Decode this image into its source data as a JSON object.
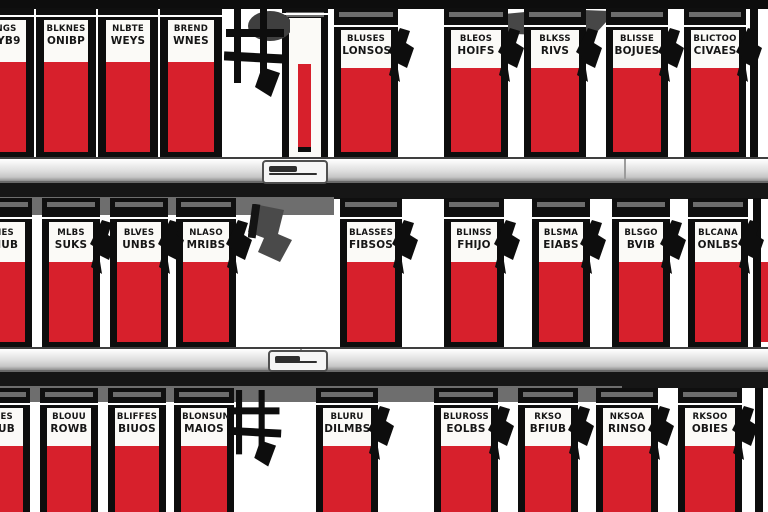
{
  "scene": {
    "description": "Illustration of store shelves stocked with red and white product packs bearing black pseudo-text labels and black hanging tags",
    "colors": {
      "pack_red": "#d7202c",
      "pack_black": "#0d0d0d",
      "label_text": "#161616",
      "shelf_gray": "#d6d6d6",
      "shadow_gray": "#6e6e6e",
      "underside_dark": "#161616",
      "background": "#ffffff"
    },
    "top_strip": {
      "x": 0,
      "y": 0,
      "w": 768,
      "h": 9
    },
    "wedge": {
      "x": 498,
      "y": 9,
      "w": 118,
      "h": 28
    },
    "rows": [
      {
        "name": "top-row",
        "top": 8,
        "height": 149,
        "style": "wide",
        "red_bottom_border": true,
        "packs": [
          {
            "x": -28,
            "w": 62,
            "style": "narrow",
            "l1": "TNGS",
            "l2": "WYB9"
          },
          {
            "x": 36,
            "w": 60,
            "style": "narrow",
            "l1": "BLKNES",
            "l2": "ONIBP"
          },
          {
            "x": 98,
            "w": 60,
            "style": "narrow",
            "l1": "NLBTE",
            "l2": "WEYS"
          },
          {
            "x": 160,
            "w": 62,
            "style": "narrow",
            "l1": "BREND",
            "l2": "WNES"
          },
          {
            "x": 282,
            "w": 46,
            "style": "side",
            "l1": "",
            "l2": ""
          },
          {
            "x": 334,
            "w": 64,
            "tag": true,
            "l1": "BLUSES",
            "l2": "LONSOS"
          },
          {
            "x": 444,
            "w": 64,
            "tag": true,
            "l1": "BLEOS",
            "l2": "HOIFS"
          },
          {
            "x": 524,
            "w": 62,
            "tag": true,
            "l1": "BLKSS",
            "l2": "RIVS"
          },
          {
            "x": 606,
            "w": 62,
            "tag": true,
            "l1": "BLISSE",
            "l2": "BOJUES"
          },
          {
            "x": 684,
            "w": 62,
            "tag": true,
            "l1": "BLICTOO",
            "l2": "CIVAES"
          }
        ]
      },
      {
        "name": "middle-row",
        "top": 198,
        "height": 149,
        "style": "row2",
        "red_bottom_border": true,
        "packs": [
          {
            "x": -24,
            "w": 56,
            "l1": "NES",
            "l2": "TIUB"
          },
          {
            "x": 42,
            "w": 58,
            "tag": true,
            "l1": "MLBS",
            "l2": "SUKS"
          },
          {
            "x": 110,
            "w": 58,
            "tag": true,
            "l1": "BLVES",
            "l2": "UNBS"
          },
          {
            "x": 176,
            "w": 60,
            "tag": true,
            "l1": "NLASO",
            "l2": "MRIBS"
          },
          {
            "x": 340,
            "w": 62,
            "tag": true,
            "l1": "BLASSES",
            "l2": "FIBSOS"
          },
          {
            "x": 444,
            "w": 60,
            "tag": true,
            "l1": "BLINSS",
            "l2": "FHIJO"
          },
          {
            "x": 532,
            "w": 58,
            "tag": true,
            "l1": "BLSMA",
            "l2": "EIABS"
          },
          {
            "x": 612,
            "w": 58,
            "tag": true,
            "l1": "BLSGO",
            "l2": "BVIB"
          },
          {
            "x": 688,
            "w": 60,
            "tag": true,
            "l1": "BLCANA",
            "l2": "ONLBS"
          }
        ]
      },
      {
        "name": "bottom-row",
        "top": 388,
        "height": 124,
        "style": "row3",
        "red_bottom_border": false,
        "packs": [
          {
            "x": -26,
            "w": 56,
            "l1": "TIES",
            "l2": "NUB"
          },
          {
            "x": 40,
            "w": 58,
            "l1": "BLOUU",
            "l2": "ROWB"
          },
          {
            "x": 108,
            "w": 58,
            "l1": "BLIFFES",
            "l2": "BIUOS"
          },
          {
            "x": 174,
            "w": 60,
            "l1": "BLONSUN",
            "l2": "MAIOS"
          },
          {
            "x": 316,
            "w": 62,
            "tag": true,
            "l1": "BLURU",
            "l2": "DILMBS"
          },
          {
            "x": 434,
            "w": 64,
            "tag": true,
            "l1": "BLUROSS",
            "l2": "EOLBS"
          },
          {
            "x": 518,
            "w": 60,
            "tag": true,
            "l1": "RKSO",
            "l2": "BFIUB"
          },
          {
            "x": 596,
            "w": 62,
            "tag": true,
            "l1": "NKSOA",
            "l2": "RINSO"
          },
          {
            "x": 678,
            "w": 64,
            "tag": true,
            "l1": "RKSOO",
            "l2": "OBIES"
          }
        ]
      }
    ],
    "shelves": [
      {
        "y": 157,
        "h": 26,
        "clip": {
          "x": 262,
          "w": 62,
          "h": 20
        },
        "seam_x": 624
      },
      {
        "y": 347,
        "h": 25,
        "clip": {
          "x": 268,
          "w": 56,
          "h": 18
        },
        "seam_x": 300
      }
    ],
    "dark_bands": [
      {
        "x": 0,
        "y": 183,
        "w": 768,
        "h": 16
      },
      {
        "x": 0,
        "y": 372,
        "w": 768,
        "h": 16
      }
    ],
    "shadow_bands": [
      {
        "x": 0,
        "y": 197,
        "w": 334,
        "h": 18
      },
      {
        "x": 0,
        "y": 386,
        "w": 622,
        "h": 16
      }
    ],
    "big_tags": [
      {
        "variant": "ladder",
        "x": 224,
        "y": 9,
        "w": 66,
        "h": 92,
        "ellipse": true
      },
      {
        "variant": "gray",
        "x": 248,
        "y": 204,
        "w": 46,
        "h": 58
      },
      {
        "variant": "ladder",
        "x": 226,
        "y": 390,
        "w": 60,
        "h": 80,
        "ellipse": false
      }
    ],
    "edge_bars": [
      {
        "x": 750,
        "y": 9,
        "w": 8,
        "h": 148
      },
      {
        "x": 753,
        "y": 198,
        "w": 8,
        "h": 149
      },
      {
        "x": 755,
        "y": 388,
        "w": 8,
        "h": 124
      }
    ],
    "red_slivers": [
      {
        "x": 761,
        "y": 262,
        "w": 7,
        "h": 80
      }
    ]
  }
}
